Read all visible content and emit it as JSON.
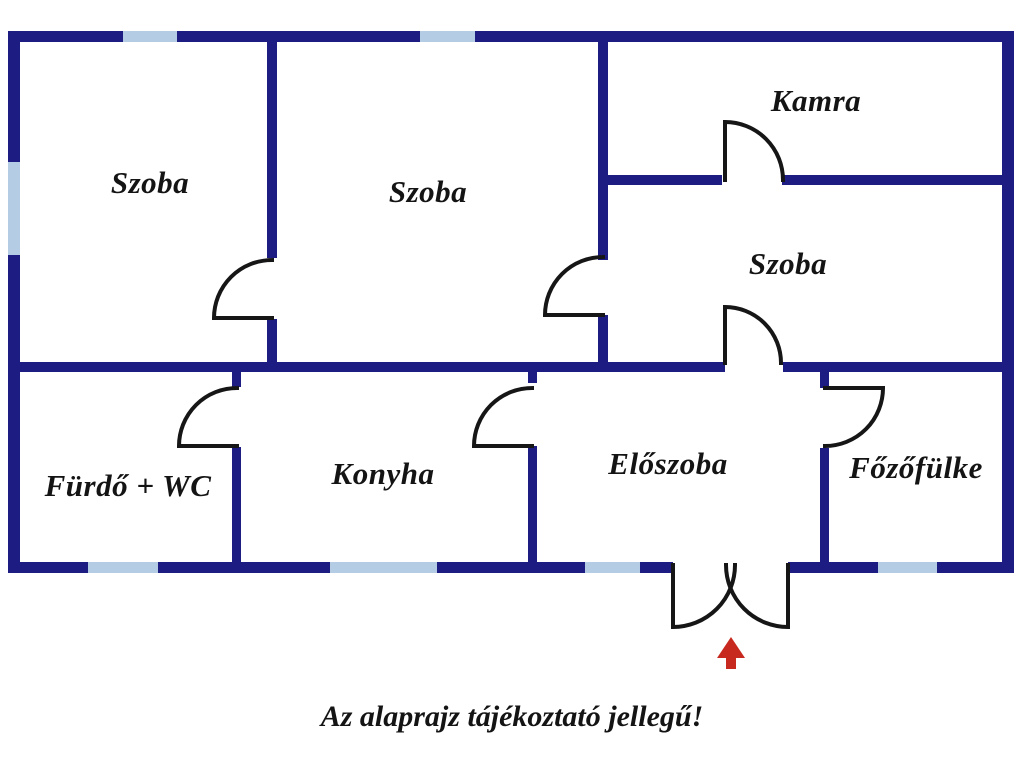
{
  "title": "floor-plan",
  "rooms": [
    {
      "id": "szoba-1",
      "label": "Szoba"
    },
    {
      "id": "szoba-2",
      "label": "Szoba"
    },
    {
      "id": "kamra",
      "label": "Kamra"
    },
    {
      "id": "szoba-3",
      "label": "Szoba"
    },
    {
      "id": "furdo-wc",
      "label": "Fürdő + WC"
    },
    {
      "id": "konyha",
      "label": "Konyha"
    },
    {
      "id": "eloszoba",
      "label": "Előszoba"
    },
    {
      "id": "fozofulke",
      "label": "Főzőfülke"
    }
  ],
  "caption": "Az alaprajz tájékoztató jellegű!",
  "colors": {
    "wall": "#1c1c82",
    "window": "#b4cde5",
    "door": "#161616",
    "arrow": "#c8291f",
    "text": "#141414",
    "background": "#ffffff"
  }
}
